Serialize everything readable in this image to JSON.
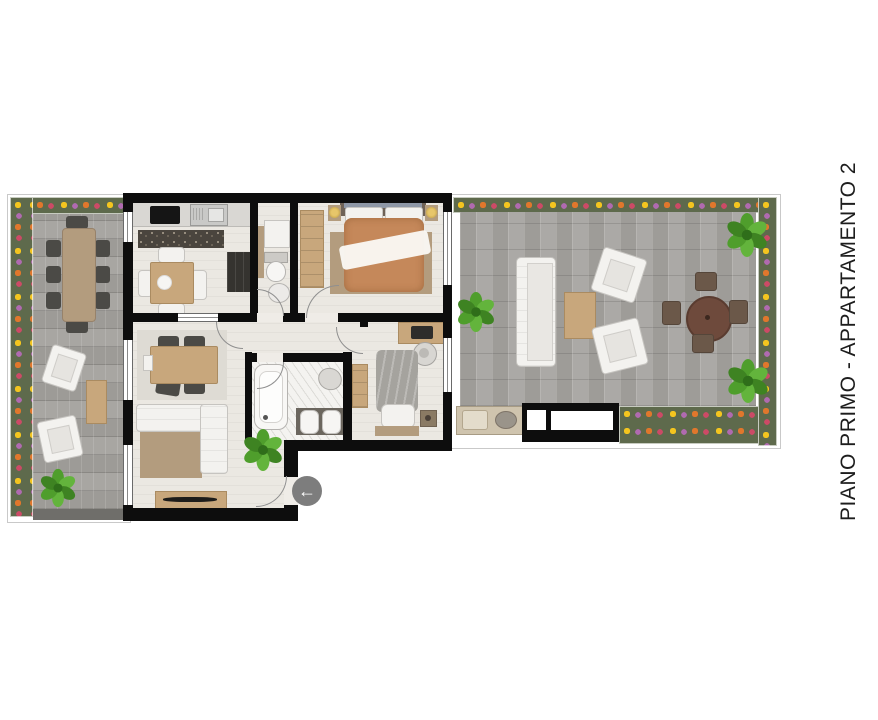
{
  "title": {
    "text": "PIANO PRIMO - APPARTAMENTO 2"
  },
  "entrance": {
    "arrow_glyph": "←"
  },
  "colors": {
    "page_bg": "#ffffff",
    "wall": "#0d0d0d",
    "interior_floor": "#ebe8e2",
    "bathroom_floor": "#f4f3f0",
    "terrace_tile": "#a6a4a0",
    "flowerbed_green": "#5e6a4c",
    "flower_yellow": "#f4c51f",
    "flower_orange": "#e0772c",
    "flower_pink": "#cc4a66",
    "flower_purple": "#b06ab0",
    "plant_green": "#55a22e",
    "wood_furniture": "#c8a77c",
    "dark_furniture": "#4b4a46",
    "master_bed_duvet": "#c5885a",
    "single_bed_duvet": "#a5a39e",
    "sofa_white": "#f3f2ef",
    "entrance_badge": "#7d7d7d"
  }
}
